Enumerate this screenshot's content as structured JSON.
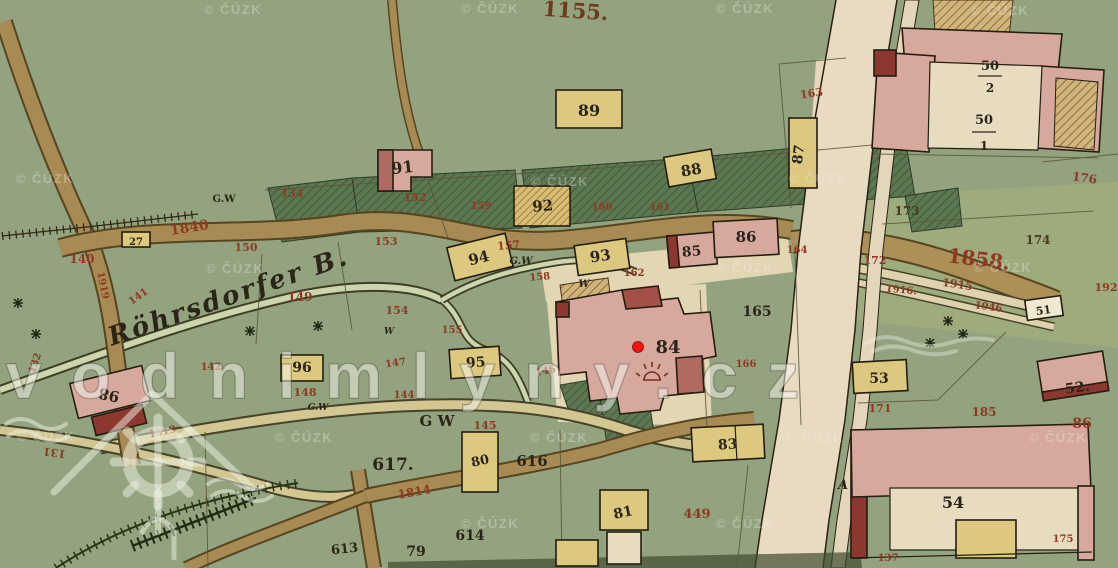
{
  "watermarks": {
    "logo_text": "vodnimlyny.cz",
    "cuzk_text": "© ČÚZK",
    "cuzk_positions": [
      {
        "x": 233,
        "y": 14
      },
      {
        "x": 490,
        "y": 13
      },
      {
        "x": 745,
        "y": 13
      },
      {
        "x": 1000,
        "y": 15
      },
      {
        "x": 45,
        "y": 183
      },
      {
        "x": 560,
        "y": 186
      },
      {
        "x": 818,
        "y": 183
      },
      {
        "x": 235,
        "y": 273
      },
      {
        "x": 745,
        "y": 272
      },
      {
        "x": 1003,
        "y": 272
      },
      {
        "x": 46,
        "y": 441
      },
      {
        "x": 304,
        "y": 442
      },
      {
        "x": 559,
        "y": 442
      },
      {
        "x": 815,
        "y": 442
      },
      {
        "x": 1058,
        "y": 442
      },
      {
        "x": 490,
        "y": 528
      },
      {
        "x": 745,
        "y": 528
      }
    ]
  },
  "marker": {
    "label": "84"
  },
  "colors": {
    "red": "#8e3a22",
    "ink": "#2b2418",
    "brown": "#6f3a1c",
    "dark": "#4a3a22",
    "background_green": "#93a37f",
    "meadow_dark": "#5d7751",
    "building_pink": "#d7a89e",
    "building_dark_red": "#8c3830",
    "building_yellow": "#dcc87e",
    "road_brown": "#a88b54",
    "road_cream": "#e9dbc2",
    "stream": "#cbd5ae",
    "marker_red": "#f31414"
  },
  "labels": [
    {
      "t": "1155.",
      "x": 575,
      "y": 18,
      "s": 21,
      "c": "brown",
      "r": 4
    },
    {
      "t": "89",
      "x": 589,
      "y": 116,
      "s": 16,
      "c": "ink"
    },
    {
      "t": "91",
      "x": 403,
      "y": 173,
      "s": 16,
      "c": "ink",
      "r": -6
    },
    {
      "t": "88",
      "x": 692,
      "y": 175,
      "s": 15,
      "c": "ink",
      "r": -10
    },
    {
      "t": "87",
      "x": 803,
      "y": 155,
      "s": 14,
      "c": "ink",
      "r": -83
    },
    {
      "t": "92",
      "x": 543,
      "y": 211,
      "s": 15,
      "c": "ink",
      "r": -4
    },
    {
      "t": "94",
      "x": 480,
      "y": 263,
      "s": 15,
      "c": "ink",
      "r": -14
    },
    {
      "t": "93",
      "x": 601,
      "y": 261,
      "s": 15,
      "c": "ink",
      "r": -8
    },
    {
      "t": "95",
      "x": 476,
      "y": 367,
      "s": 14,
      "c": "ink",
      "r": -4
    },
    {
      "t": "96",
      "x": 302,
      "y": 372,
      "s": 14,
      "c": "ink"
    },
    {
      "t": "80",
      "x": 481,
      "y": 465,
      "s": 13,
      "c": "ink",
      "r": -12
    },
    {
      "t": "83",
      "x": 728,
      "y": 449,
      "s": 14,
      "c": "ink",
      "r": -4
    },
    {
      "t": "81",
      "x": 624,
      "y": 517,
      "s": 14,
      "c": "ink",
      "r": -12
    },
    {
      "t": "85",
      "x": 692,
      "y": 256,
      "s": 14,
      "c": "ink",
      "r": -5
    },
    {
      "t": "86",
      "x": 746,
      "y": 242,
      "s": 15,
      "c": "ink"
    },
    {
      "t": "84",
      "x": 668,
      "y": 353,
      "s": 18,
      "c": "ink"
    },
    {
      "t": "98",
      "x": 110,
      "y": 390,
      "s": 15,
      "c": "ink",
      "r": 192
    },
    {
      "t": "27",
      "x": 136,
      "y": 245,
      "s": 10,
      "c": "ink"
    },
    {
      "t": "50",
      "x": 990,
      "y": 70,
      "s": 13,
      "c": "ink"
    },
    {
      "t": "2",
      "x": 990,
      "y": 92,
      "s": 12,
      "c": "ink"
    },
    {
      "t": "50",
      "x": 984,
      "y": 124,
      "s": 13,
      "c": "ink"
    },
    {
      "t": "1",
      "x": 984,
      "y": 150,
      "s": 12,
      "c": "ink"
    },
    {
      "t": "51",
      "x": 1044,
      "y": 314,
      "s": 11,
      "c": "ink",
      "r": -8
    },
    {
      "t": "52.",
      "x": 1078,
      "y": 392,
      "s": 14,
      "c": "ink",
      "r": -8
    },
    {
      "t": "53",
      "x": 879,
      "y": 383,
      "s": 14,
      "c": "ink"
    },
    {
      "t": "54",
      "x": 953,
      "y": 508,
      "s": 16,
      "c": "ink"
    },
    {
      "t": "617.",
      "x": 393,
      "y": 470,
      "s": 17,
      "c": "ink"
    },
    {
      "t": "616",
      "x": 532,
      "y": 466,
      "s": 15,
      "c": "ink"
    },
    {
      "t": "614",
      "x": 470,
      "y": 540,
      "s": 14,
      "c": "ink"
    },
    {
      "t": "613",
      "x": 345,
      "y": 553,
      "s": 13,
      "c": "ink",
      "r": -6
    },
    {
      "t": "79",
      "x": 416,
      "y": 556,
      "s": 14,
      "c": "ink"
    },
    {
      "t": "165",
      "x": 757,
      "y": 316,
      "s": 14,
      "c": "ink"
    },
    {
      "t": "174",
      "x": 1038,
      "y": 244,
      "s": 12,
      "c": "dark"
    },
    {
      "t": "173",
      "x": 907,
      "y": 215,
      "s": 12,
      "c": "dark"
    },
    {
      "t": "A",
      "x": 843,
      "y": 489,
      "s": 13,
      "c": "ink",
      "i": 1
    },
    {
      "t": "G.W",
      "x": 224,
      "y": 202,
      "s": 10,
      "c": "ink"
    },
    {
      "t": "G.W",
      "x": 521,
      "y": 264,
      "s": 10,
      "c": "ink",
      "i": 1
    },
    {
      "t": "W",
      "x": 584,
      "y": 287,
      "s": 10,
      "c": "ink",
      "i": 1
    },
    {
      "t": "W",
      "x": 389,
      "y": 334,
      "s": 9,
      "c": "ink",
      "i": 1
    },
    {
      "t": "G.W",
      "x": 318,
      "y": 410,
      "s": 9,
      "c": "ink",
      "i": 1
    },
    {
      "t": "G W",
      "x": 437,
      "y": 426,
      "s": 15,
      "c": "ink"
    },
    {
      "t": "Röhrsdorfer B.",
      "x": 230,
      "y": 305,
      "s": 26,
      "c": "ink",
      "r": -19,
      "i": 1,
      "w": 250
    },
    {
      "t": "134",
      "x": 292,
      "y": 197,
      "s": 11,
      "c": "red"
    },
    {
      "t": "1840",
      "x": 190,
      "y": 232,
      "s": 14,
      "c": "red",
      "r": -9
    },
    {
      "t": "150",
      "x": 246,
      "y": 251,
      "s": 11,
      "c": "red"
    },
    {
      "t": "152",
      "x": 415,
      "y": 201,
      "s": 11,
      "c": "red"
    },
    {
      "t": "153",
      "x": 386,
      "y": 245,
      "s": 11,
      "c": "red"
    },
    {
      "t": "149",
      "x": 300,
      "y": 301,
      "s": 12,
      "c": "red"
    },
    {
      "t": "154",
      "x": 397,
      "y": 314,
      "s": 11,
      "c": "red"
    },
    {
      "t": "155",
      "x": 452,
      "y": 333,
      "s": 10,
      "c": "red"
    },
    {
      "t": "157",
      "x": 509,
      "y": 249,
      "s": 11,
      "c": "red",
      "r": -5
    },
    {
      "t": "158",
      "x": 540,
      "y": 280,
      "s": 10,
      "c": "red",
      "r": -5
    },
    {
      "t": "159",
      "x": 481,
      "y": 209,
      "s": 10,
      "c": "red"
    },
    {
      "t": "160",
      "x": 602,
      "y": 210,
      "s": 10,
      "c": "red"
    },
    {
      "t": "161",
      "x": 660,
      "y": 210,
      "s": 10,
      "c": "red"
    },
    {
      "t": "162",
      "x": 634,
      "y": 276,
      "s": 10,
      "c": "red"
    },
    {
      "t": "164",
      "x": 797,
      "y": 253,
      "s": 10,
      "c": "red"
    },
    {
      "t": "166",
      "x": 746,
      "y": 367,
      "s": 10,
      "c": "red"
    },
    {
      "t": "163",
      "x": 812,
      "y": 97,
      "s": 11,
      "c": "red",
      "r": -8
    },
    {
      "t": "176",
      "x": 1084,
      "y": 182,
      "s": 12,
      "c": "red",
      "r": 8
    },
    {
      "t": "140",
      "x": 82,
      "y": 263,
      "s": 12,
      "c": "red"
    },
    {
      "t": "141",
      "x": 140,
      "y": 299,
      "s": 10,
      "c": "red",
      "r": -35
    },
    {
      "t": "142",
      "x": 211,
      "y": 370,
      "s": 10,
      "c": "red"
    },
    {
      "t": "143",
      "x": 116,
      "y": 424,
      "s": 10,
      "c": "red",
      "r": -10
    },
    {
      "t": "144",
      "x": 404,
      "y": 398,
      "s": 10,
      "c": "red"
    },
    {
      "t": "145",
      "x": 485,
      "y": 429,
      "s": 11,
      "c": "red"
    },
    {
      "t": "146",
      "x": 546,
      "y": 374,
      "s": 10,
      "c": "red",
      "r": -10
    },
    {
      "t": "147",
      "x": 396,
      "y": 366,
      "s": 10,
      "c": "red",
      "r": -8
    },
    {
      "t": "148",
      "x": 305,
      "y": 396,
      "s": 11,
      "c": "red"
    },
    {
      "t": "131",
      "x": 55,
      "y": 449,
      "s": 11,
      "c": "red",
      "r": 188
    },
    {
      "t": "132",
      "x": 38,
      "y": 364,
      "s": 10,
      "c": "red",
      "r": -72
    },
    {
      "t": "1919",
      "x": 100,
      "y": 286,
      "s": 10,
      "c": "red",
      "r": 78
    },
    {
      "t": "1919",
      "x": 163,
      "y": 435,
      "s": 10,
      "c": "red",
      "r": -12
    },
    {
      "t": "1814",
      "x": 415,
      "y": 496,
      "s": 12,
      "c": "red",
      "r": -10
    },
    {
      "t": "1858.",
      "x": 978,
      "y": 266,
      "s": 20,
      "c": "red",
      "r": 7
    },
    {
      "t": "1915",
      "x": 957,
      "y": 288,
      "s": 11,
      "c": "red",
      "r": 8
    },
    {
      "t": "1916.",
      "x": 901,
      "y": 293,
      "s": 10,
      "c": "red",
      "r": 5
    },
    {
      "t": "1946",
      "x": 988,
      "y": 310,
      "s": 10,
      "c": "red",
      "r": 8
    },
    {
      "t": "172",
      "x": 875,
      "y": 264,
      "s": 11,
      "c": "red"
    },
    {
      "t": "171",
      "x": 880,
      "y": 412,
      "s": 11,
      "c": "red"
    },
    {
      "t": "185",
      "x": 984,
      "y": 416,
      "s": 12,
      "c": "red"
    },
    {
      "t": "86",
      "x": 1082,
      "y": 428,
      "s": 14,
      "c": "red"
    },
    {
      "t": "192",
      "x": 1106,
      "y": 291,
      "s": 11,
      "c": "red"
    },
    {
      "t": "449",
      "x": 697,
      "y": 518,
      "s": 13,
      "c": "red"
    },
    {
      "t": "137",
      "x": 888,
      "y": 561,
      "s": 10,
      "c": "red"
    },
    {
      "t": "175",
      "x": 1063,
      "y": 542,
      "s": 10,
      "c": "red"
    }
  ]
}
